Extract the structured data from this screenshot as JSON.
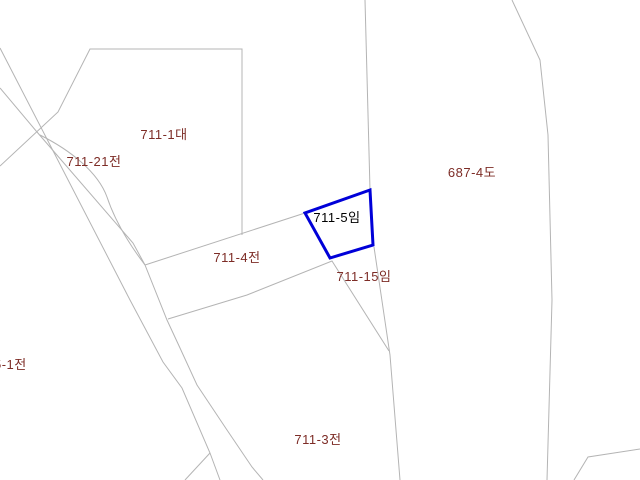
{
  "map": {
    "type": "cadastral-parcel-map",
    "background_color": "#ffffff",
    "boundary_line_color": "#b4b4b4",
    "label_color": "#7d2c26",
    "highlighted_parcel": {
      "label": "711-5임",
      "outline_color": "#0000d8",
      "label_color": "#000000"
    },
    "labels": [
      {
        "id": "parcel-711-1",
        "text": "711-1대"
      },
      {
        "id": "parcel-711-21",
        "text": "711-21전"
      },
      {
        "id": "parcel-687-4",
        "text": "687-4도"
      },
      {
        "id": "parcel-711-5",
        "text": "711-5임"
      },
      {
        "id": "parcel-711-4",
        "text": "711-4전"
      },
      {
        "id": "parcel-711-15",
        "text": "711-15임"
      },
      {
        "id": "parcel-5-1",
        "text": "5-1전"
      },
      {
        "id": "parcel-711-3",
        "text": "711-3전"
      }
    ]
  }
}
